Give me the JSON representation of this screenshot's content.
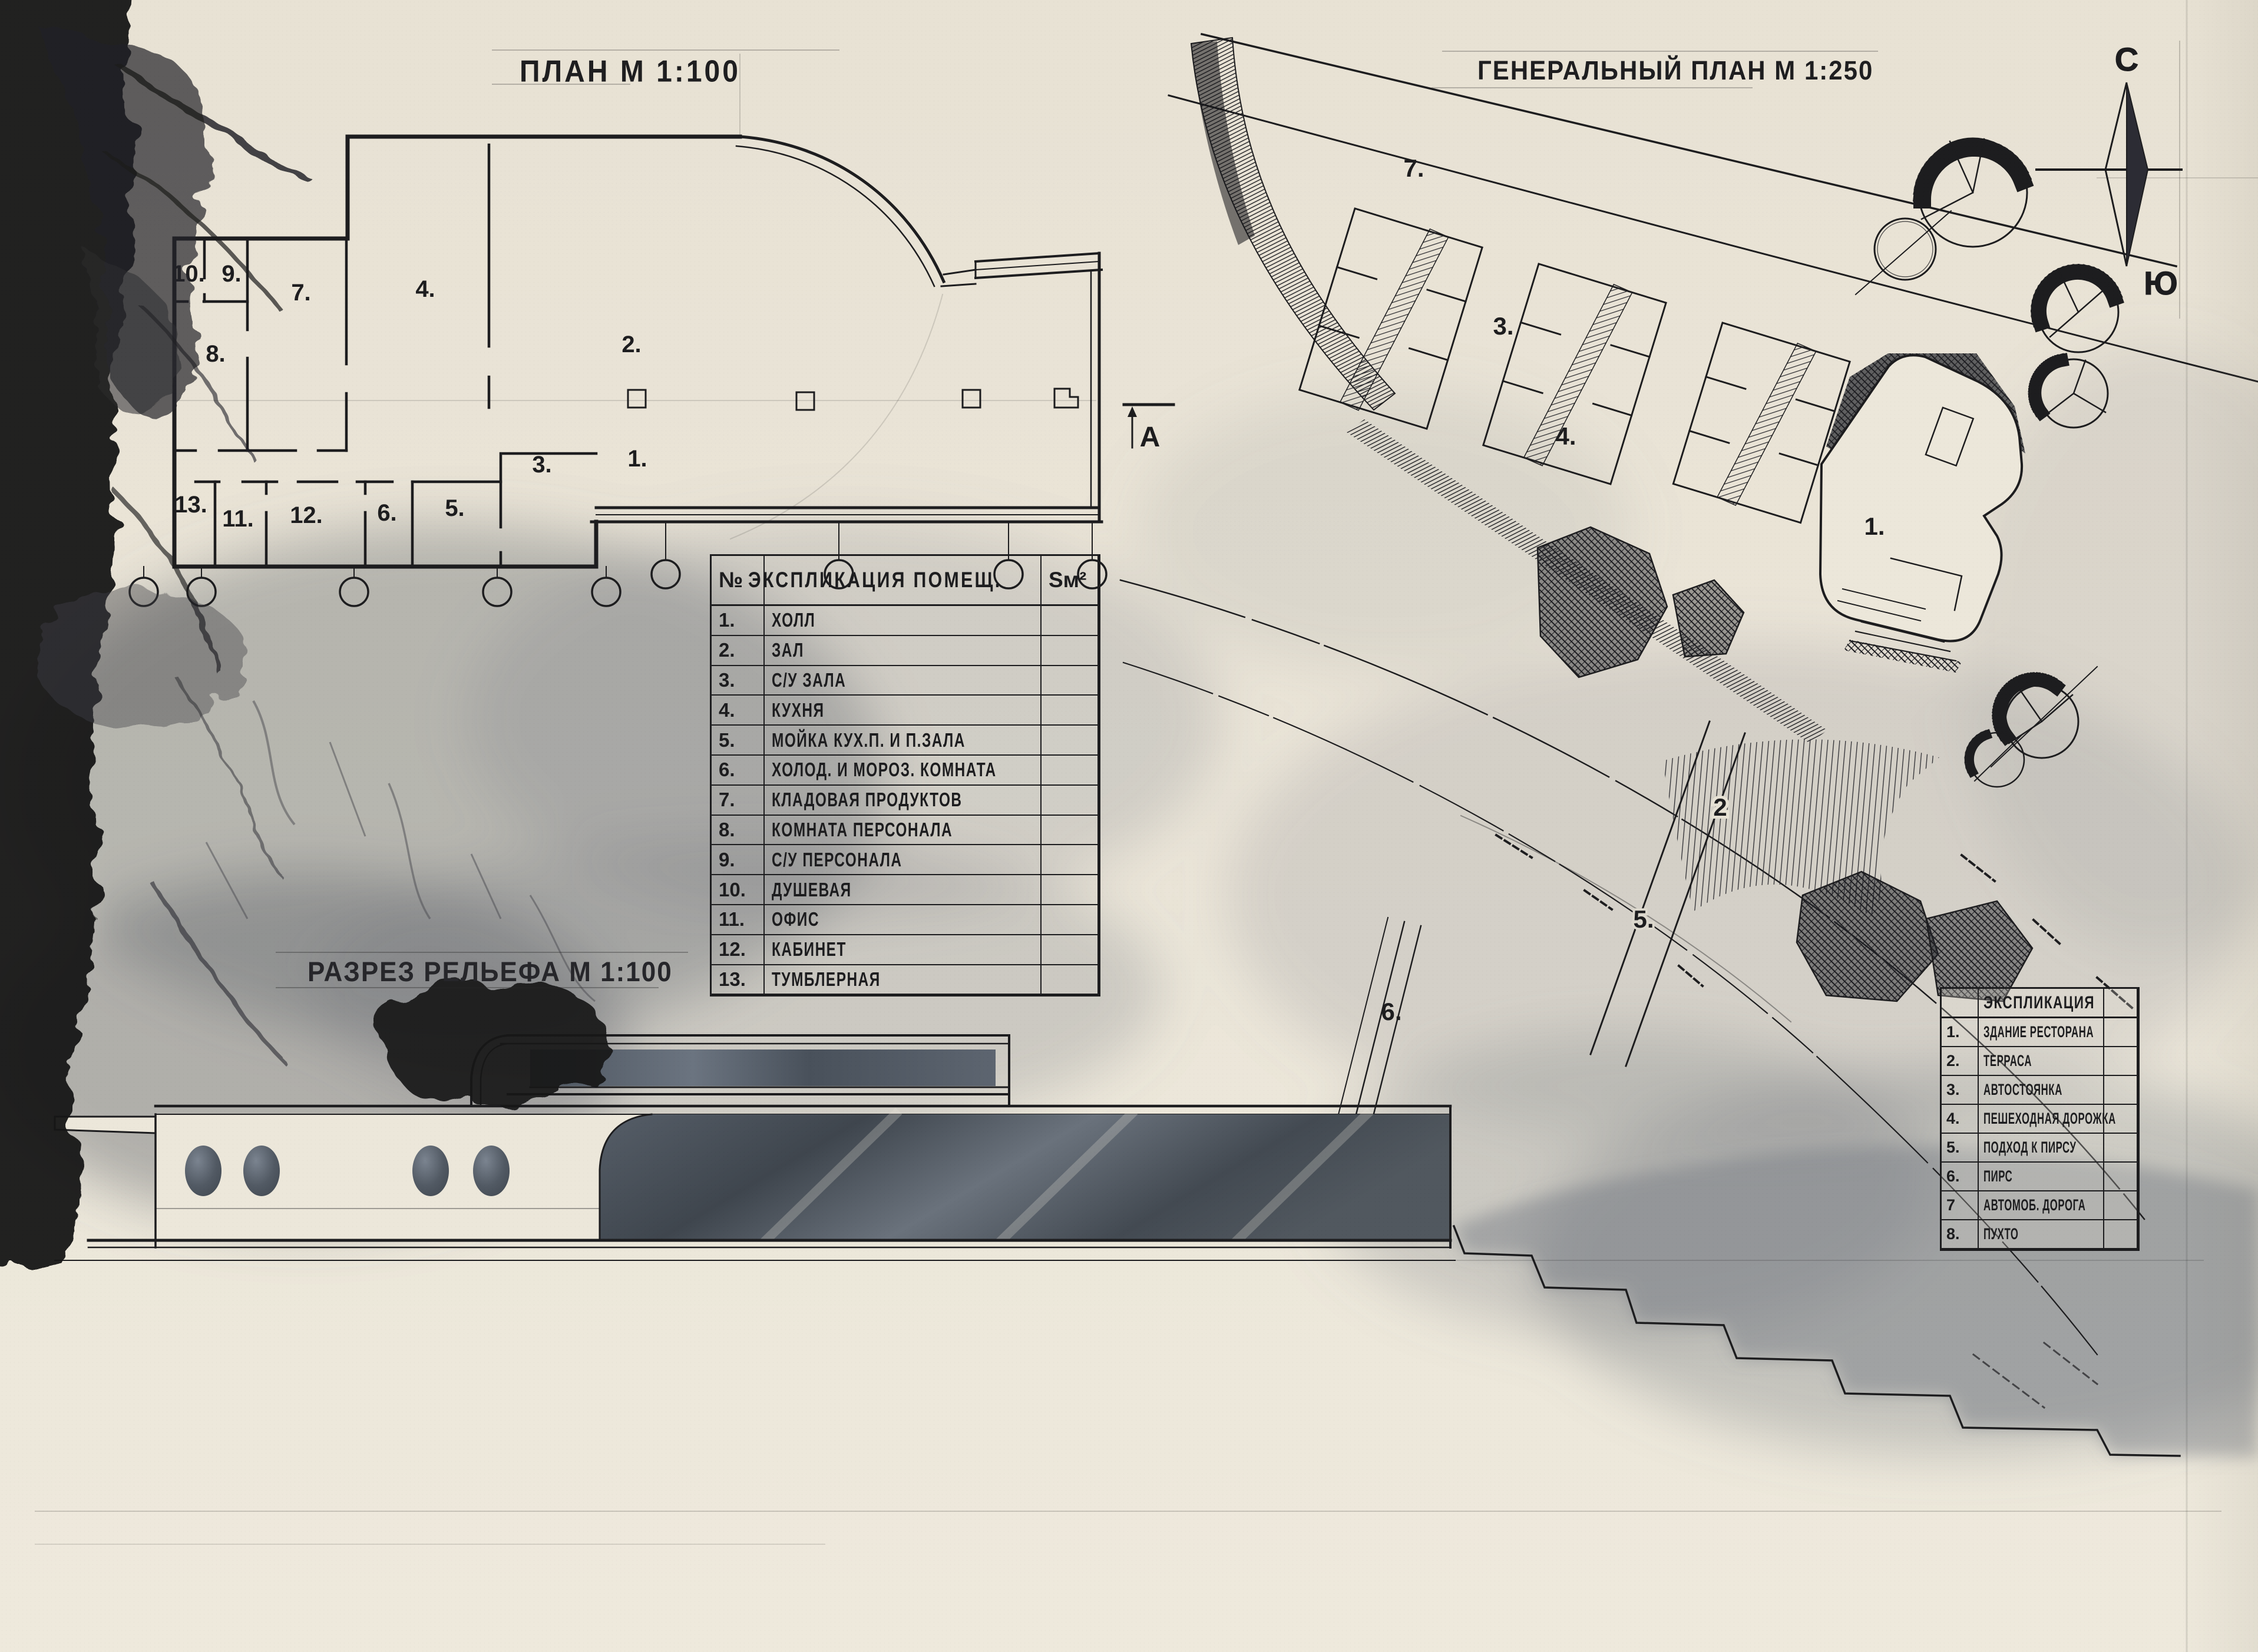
{
  "titles": {
    "floor_plan": "ПЛАН М 1:100",
    "master_plan": "ГЕНЕРАЛЬНЫЙ ПЛАН М 1:250",
    "terrain_section": "РАЗРЕЗ РЕЛЬЕФА М 1:100"
  },
  "compass": {
    "north": "С",
    "south": "Ю"
  },
  "section_marker": "А",
  "floor_plan": {
    "room_labels": [
      "10.",
      "9.",
      "7.",
      "4.",
      "2.",
      "8.",
      "13.",
      "11.",
      "12.",
      "6.",
      "5.",
      "3.",
      "1."
    ]
  },
  "site_plan": {
    "labels": {
      "road": "7.",
      "parking": "3.",
      "path": "4.",
      "building": "1.",
      "terrace": "2",
      "pier_approach": "5.",
      "pier": "6."
    }
  },
  "room_table": {
    "col_num": "№",
    "col_name": "ЭКСПЛИКАЦИЯ ПОМЕЩ.",
    "col_area": "Sм²",
    "rows": [
      {
        "num": "1.",
        "label": "ХОЛЛ"
      },
      {
        "num": "2.",
        "label": "ЗАЛ"
      },
      {
        "num": "3.",
        "label": "С/У ЗАЛА"
      },
      {
        "num": "4.",
        "label": "КУХНЯ"
      },
      {
        "num": "5.",
        "label": "МОЙКА КУХ.П. И П.ЗАЛА"
      },
      {
        "num": "6.",
        "label": "ХОЛОД. И МОРОЗ. КОМНАТА"
      },
      {
        "num": "7.",
        "label": "КЛАДОВАЯ ПРОДУКТОВ"
      },
      {
        "num": "8.",
        "label": "КОМНАТА ПЕРСОНАЛА"
      },
      {
        "num": "9.",
        "label": "С/У ПЕРСОНАЛА"
      },
      {
        "num": "10.",
        "label": "ДУШЕВАЯ"
      },
      {
        "num": "11.",
        "label": "ОФИС"
      },
      {
        "num": "12.",
        "label": "КАБИНЕТ"
      },
      {
        "num": "13.",
        "label": "ТУМБЛЕРНАЯ"
      }
    ]
  },
  "site_table": {
    "header": "ЭКСПЛИКАЦИЯ",
    "rows": [
      {
        "num": "1.",
        "label": "ЗДАНИЕ РЕСТОРАНА"
      },
      {
        "num": "2.",
        "label": "ТЕРРАСА"
      },
      {
        "num": "3.",
        "label": "АВТОСТОЯНКА"
      },
      {
        "num": "4.",
        "label": "ПЕШЕХОДНАЯ ДОРОЖКА"
      },
      {
        "num": "5.",
        "label": "ПОДХОД К ПИРСУ"
      },
      {
        "num": "6.",
        "label": "ПИРС"
      },
      {
        "num": "7",
        "label": "АВТОМОБ. ДОРОГА"
      },
      {
        "num": "8.",
        "label": "ПУХТО"
      }
    ]
  },
  "colors": {
    "paper": "#eae4d6",
    "ink": "#1d1d1f",
    "wash": "#79808a"
  }
}
